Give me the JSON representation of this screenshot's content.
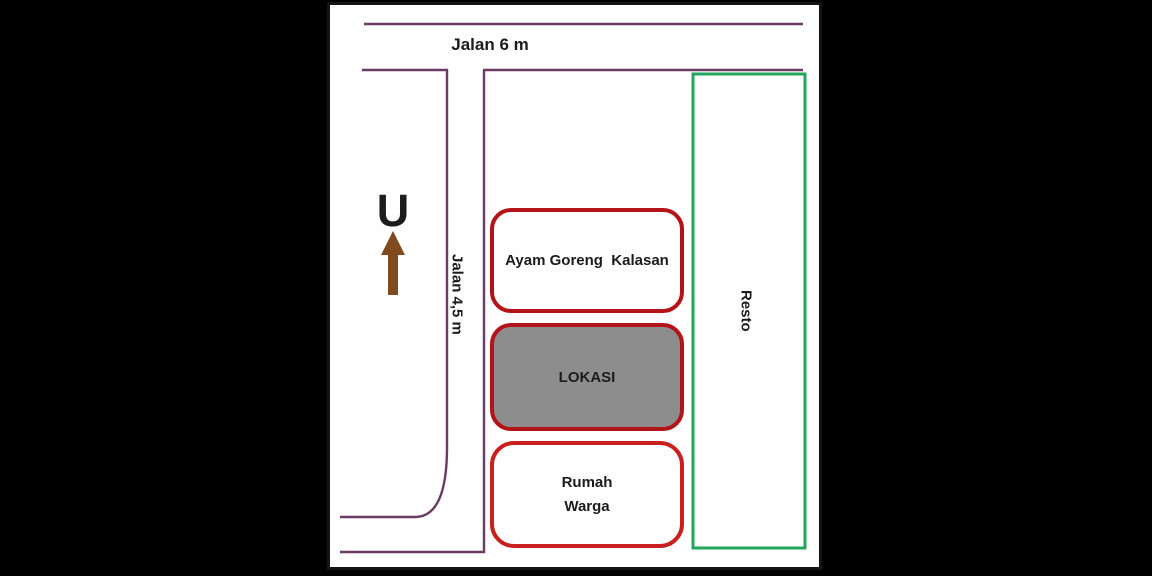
{
  "colors": {
    "page_background": "#000000",
    "canvas_background": "#fefefe",
    "canvas_border": "#141414",
    "road_purple": "#6b3a66",
    "box_red_dark": "#b41418",
    "box_red_bright": "#c9201f",
    "lokasi_gray_fill": "#8d8d8d",
    "resto_green": "#22a55c",
    "arrow_brown": "#82481e",
    "text": "#1c1c1c"
  },
  "map": {
    "north_letter": "U",
    "road_top_label": "Jalan 6 m",
    "road_side_label": "Jalan 4,5 m",
    "buildings": {
      "ayam": "Ayam Goreng  Kalasan",
      "lokasi": "LOKASI",
      "rumah_line1": "Rumah",
      "rumah_line2": "Warga",
      "resto": "Resto"
    }
  }
}
